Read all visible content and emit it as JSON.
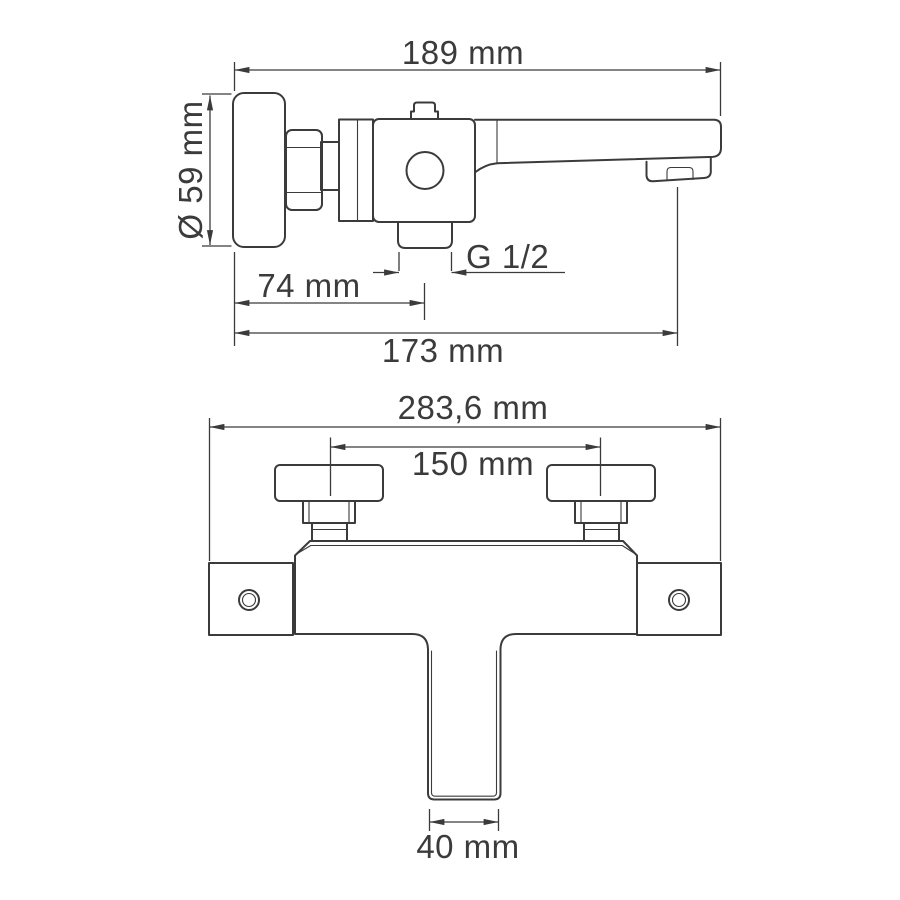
{
  "drawing": {
    "side_view": {
      "total_length_label": "189 mm",
      "escutcheon_diameter_label": "Ø 59 mm",
      "thread_size_label": "G 1/2",
      "wall_to_shower_outlet_label": "74 mm",
      "wall_to_spout_outlet_label": "173 mm"
    },
    "front_view": {
      "overall_width_label": "283,6 mm",
      "connection_centers_label": "150 mm",
      "spout_width_label": "40 mm"
    },
    "colors": {
      "line": "#3b3b3b",
      "background": "#ffffff"
    }
  }
}
